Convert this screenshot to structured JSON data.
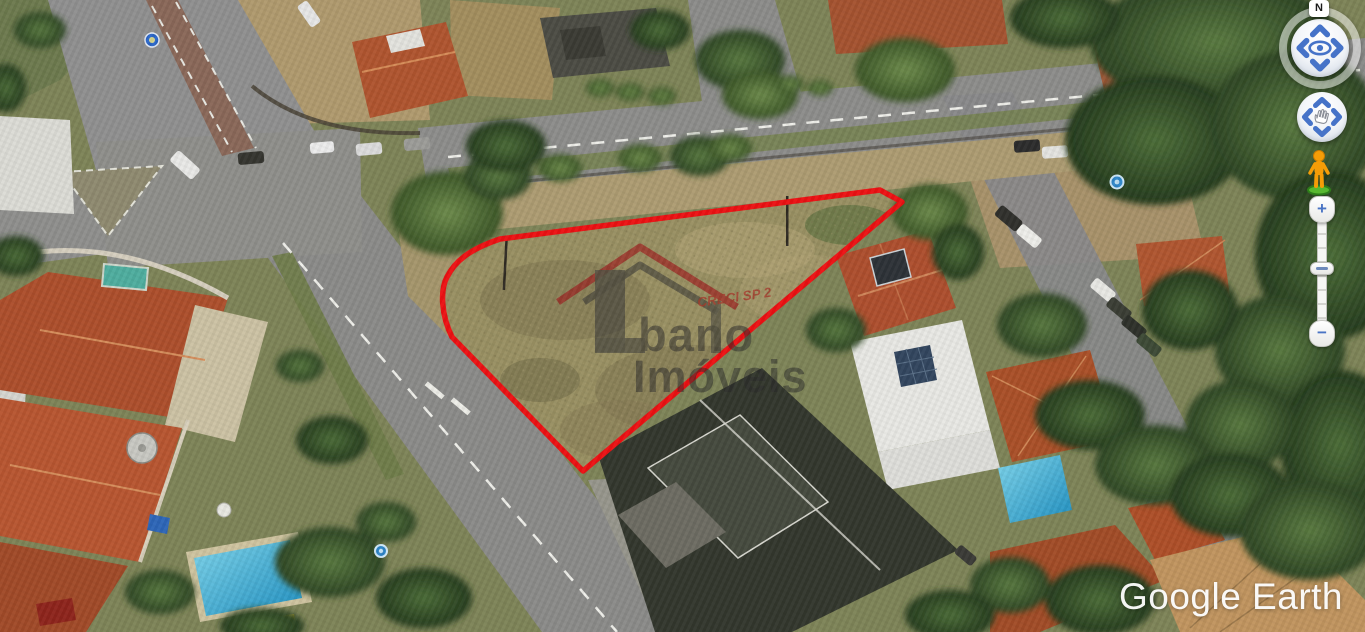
{
  "app": {
    "wordmark": "Google Earth"
  },
  "navigation": {
    "north_label": "N",
    "zoom_in_label": "+",
    "zoom_out_label": "−"
  },
  "watermark": {
    "brand_part1": "bano",
    "brand_part2": "Imóveis",
    "license": "CRECI SP 2",
    "logo_color": "#9e1217"
  },
  "map": {
    "lot_outline_color": "#ed1113",
    "marker_color": "#2f86c8"
  }
}
